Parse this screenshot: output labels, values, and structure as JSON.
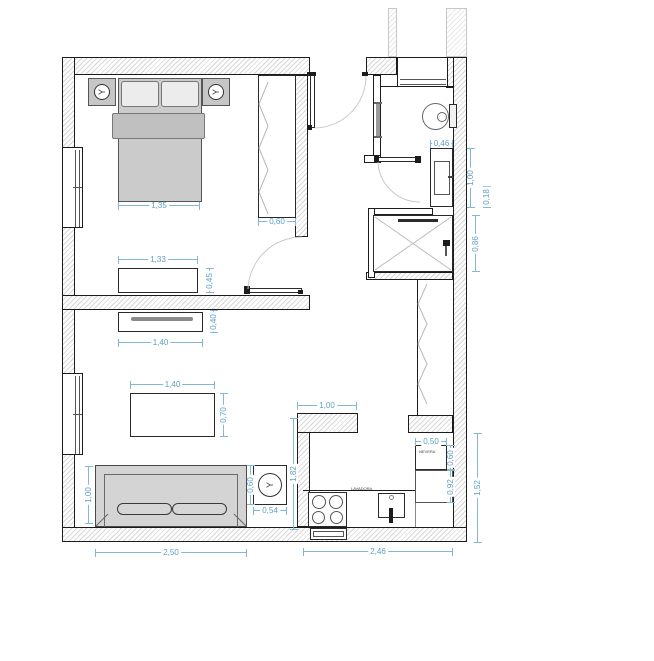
{
  "meta": {
    "drawing_type": "apartment floor plan",
    "units": "m",
    "dimension_color": "#82b8d6",
    "wall_hatch_color": "#d7d7d7"
  },
  "labels": {
    "fridge": "NEVERA",
    "washer": "LAVADORA"
  },
  "icons": {
    "lamp_glyph": "Y"
  },
  "dimensions": {
    "bedroom": {
      "bed_width": "1,35",
      "wardrobe_depth": "0,60",
      "dresser_width": "1,33",
      "dresser_depth": "0,45"
    },
    "living": {
      "tv_unit_width": "1,40",
      "tv_unit_depth": "0,40",
      "coffee_table_width": "1,40",
      "coffee_table_depth": "0,70",
      "sofa_width": "2,50",
      "sofa_depth": "1,00",
      "side_table_width": "0,54",
      "side_table_depth": "0,60",
      "right_clearance": "1,82"
    },
    "kitchen": {
      "entry_width": "1,00",
      "fridge_width": "0,50",
      "fridge_depth": "0,60",
      "counter_run": "0,92",
      "right_side_depth": "1,52",
      "total_width": "2,46"
    },
    "bathroom": {
      "sink_width": "0,46",
      "sink_length": "1,00",
      "ledge": "0,18",
      "shower_width": "0,86"
    }
  }
}
